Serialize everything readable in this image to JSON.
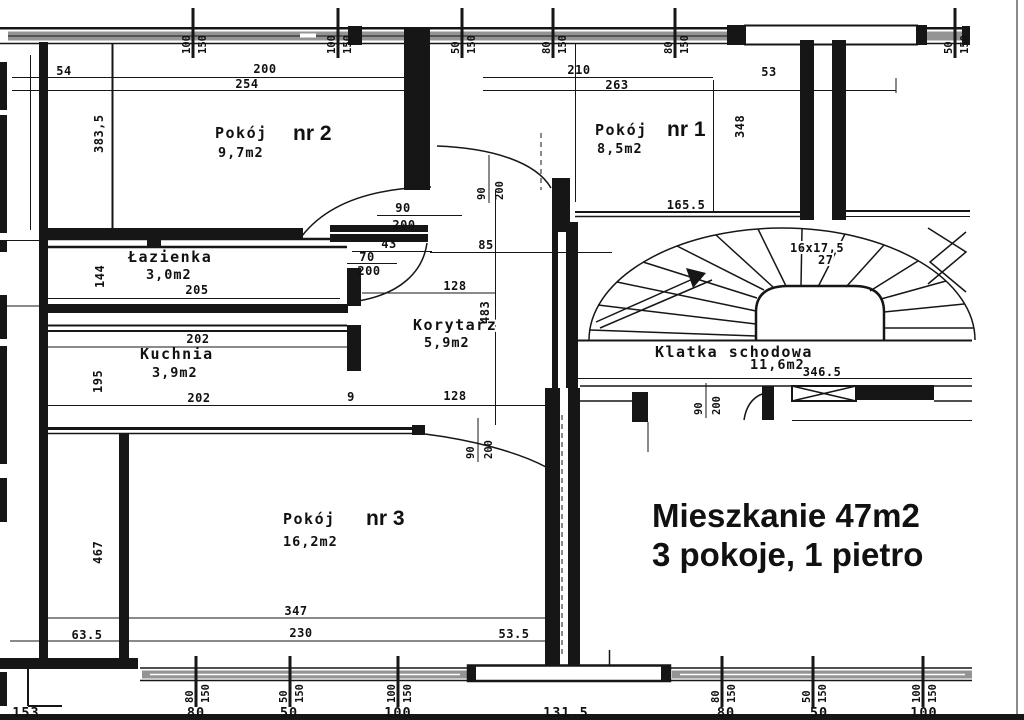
{
  "colors": {
    "ink": "#161616",
    "paper": "#ffffff",
    "glazing": "#949494"
  },
  "annotation": {
    "line1": "Mieszkanie 47m2",
    "line2": "3 pokoje, 1 pietro"
  },
  "rooms": {
    "pokoj2": {
      "name": "Pokój",
      "nr": "nr 2",
      "area": "9,7m2"
    },
    "pokoj1": {
      "name": "Pokój",
      "nr": "nr 1",
      "area": "8,5m2"
    },
    "pokoj3": {
      "name": "Pokój",
      "nr": "nr 3",
      "area": "16,2m2"
    },
    "lazienka": {
      "name": "Łazienka",
      "area": "3,0m2"
    },
    "kuchnia": {
      "name": "Kuchnia",
      "area": "3,9m2"
    },
    "korytarz": {
      "name": "Korytarz",
      "area": "5,9m2"
    },
    "klatka": {
      "name": "Klatka schodowa",
      "area": "11,6m2"
    }
  },
  "stairs": {
    "run": "16x17,5",
    "riser": "27"
  },
  "dims": {
    "p2_54": "54",
    "p2_w1": "200",
    "p2_w2": "254",
    "p2_h": "383,5",
    "p1_w1": "210",
    "p1_w2": "263",
    "p1_53": "53",
    "p1_h": "348",
    "p1_165": "165.5",
    "laz_w": "205",
    "laz_h": "144",
    "ku_w1": "202",
    "ku_w2": "202",
    "ku_9": "9",
    "ku_h": "195",
    "kor_85": "85",
    "kor_128a": "128",
    "kor_128b": "128",
    "kor_h": "483",
    "p3_w1": "347",
    "p3_w2": "230",
    "p3_63": "63.5",
    "p3_53": "53.5",
    "p3_h": "467",
    "klatka_w": "346.5"
  },
  "doors": {
    "d_p2": {
      "w": "90",
      "h": "200"
    },
    "d_p1": {
      "w": "90",
      "h": "200"
    },
    "d_laz": {
      "a": "43",
      "w": "70",
      "h": "200"
    },
    "d_p3": {
      "w": "90",
      "h": "200"
    },
    "d_ent": {
      "w": "90",
      "h": "200"
    }
  },
  "markers": {
    "top": [
      {
        "a": "100",
        "b": "150"
      },
      {
        "a": "100",
        "b": "150"
      },
      {
        "a": "50",
        "b": "150"
      },
      {
        "a": "80",
        "b": "150"
      },
      {
        "a": "80",
        "b": "150"
      },
      {
        "a": "50",
        "b": "150"
      }
    ],
    "bottom": [
      {
        "a": "80",
        "b": "150"
      },
      {
        "a": "50",
        "b": "150"
      },
      {
        "a": "100",
        "b": "150"
      },
      {
        "a": "80",
        "b": "150"
      },
      {
        "a": "50",
        "b": "150"
      },
      {
        "a": "100",
        "b": "150"
      }
    ]
  },
  "bottom_numbers": [
    "153",
    "80",
    "50",
    "100",
    "131.5",
    "80",
    "50",
    "100"
  ]
}
